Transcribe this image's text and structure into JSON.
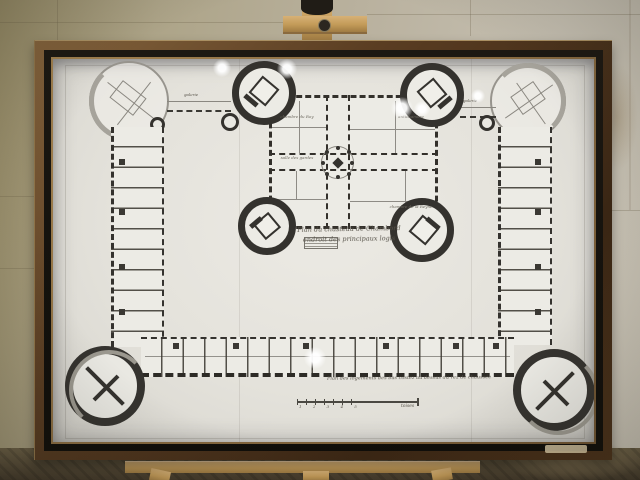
{
  "scene": {
    "setting": "framed chateau plan drawing on a wooden easel against a stone wall",
    "colors": {
      "wall": "#b3ab97",
      "wall_left": "#968b66",
      "floor": "#564a33",
      "easel_wood": "#c9a263",
      "frame_wood": "#5a3d22",
      "frame_black_band": "#16130e",
      "frame_gilt": "#8f7147",
      "paper": "#e6e4de",
      "ink_dark": "#33312c",
      "ink_light": "#93908a"
    }
  },
  "drawing": {
    "caption_center_line1": "Plan du chasteau de Chambord",
    "caption_center_line2": "endroit des principaux logis",
    "caption_bottom": "Plan des logements des bas costez au dessus du rez de chaussée",
    "gallery_label_left": "galerie",
    "gallery_label_right": "galerie",
    "scale_numbers": "1 2 3 4 5",
    "scale_label": "toises",
    "room_labels": [
      "chambre du Roy",
      "antichambre",
      "salle des gardes",
      "chambre de la Reyne"
    ]
  }
}
